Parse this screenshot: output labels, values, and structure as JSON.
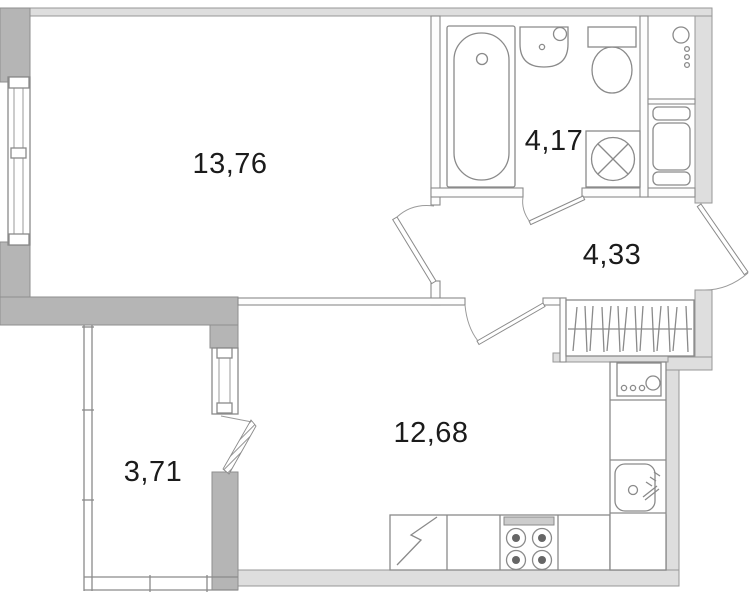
{
  "floor_plan": {
    "rooms": [
      {
        "id": "living-room",
        "area_label": "13,76"
      },
      {
        "id": "bathroom",
        "area_label": "4,17"
      },
      {
        "id": "hallway",
        "area_label": "4,33"
      },
      {
        "id": "kitchen-living-room",
        "area_label": "12,68"
      },
      {
        "id": "balcony",
        "area_label": "3,71"
      }
    ],
    "fixtures": [
      "bathtub",
      "wash-basin",
      "toilet",
      "washing-machine",
      "ventilation-shaft",
      "heater-column",
      "wardrobe-with-hangers",
      "kitchen-counter",
      "refrigerator",
      "stove-4-burners",
      "kitchen-sink",
      "hob-unit",
      "entrance-door",
      "interior-doors",
      "balcony-door",
      "window-living-room",
      "window-balcony",
      "balcony-glazing"
    ],
    "colors": {
      "background": "#ffffff",
      "wall_thick": "#b5b5b5",
      "wall_thin": "#dedede",
      "outline": "#8a8a8a",
      "text": "#1b1b1b"
    }
  }
}
